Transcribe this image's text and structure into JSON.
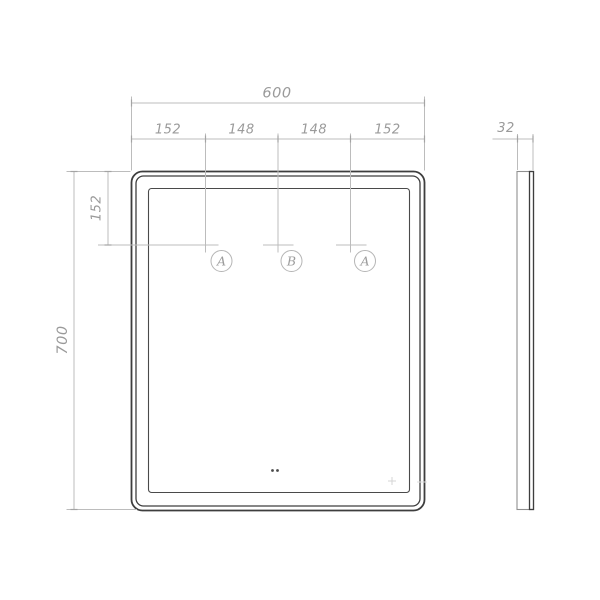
{
  "front_view": {
    "overall_width": "600",
    "top_segments": [
      "152",
      "148",
      "148",
      "152"
    ],
    "overall_height": "700",
    "left_top_offset": "152",
    "markers": [
      "A",
      "B",
      "A"
    ]
  },
  "side_view": {
    "thickness": "32"
  },
  "colors": {
    "outline_dark": "#3e3e3e",
    "outline_medium": "#8f8f8f",
    "dimension_line": "#b9b9b9",
    "dimension_text": "#9a9a9a"
  }
}
